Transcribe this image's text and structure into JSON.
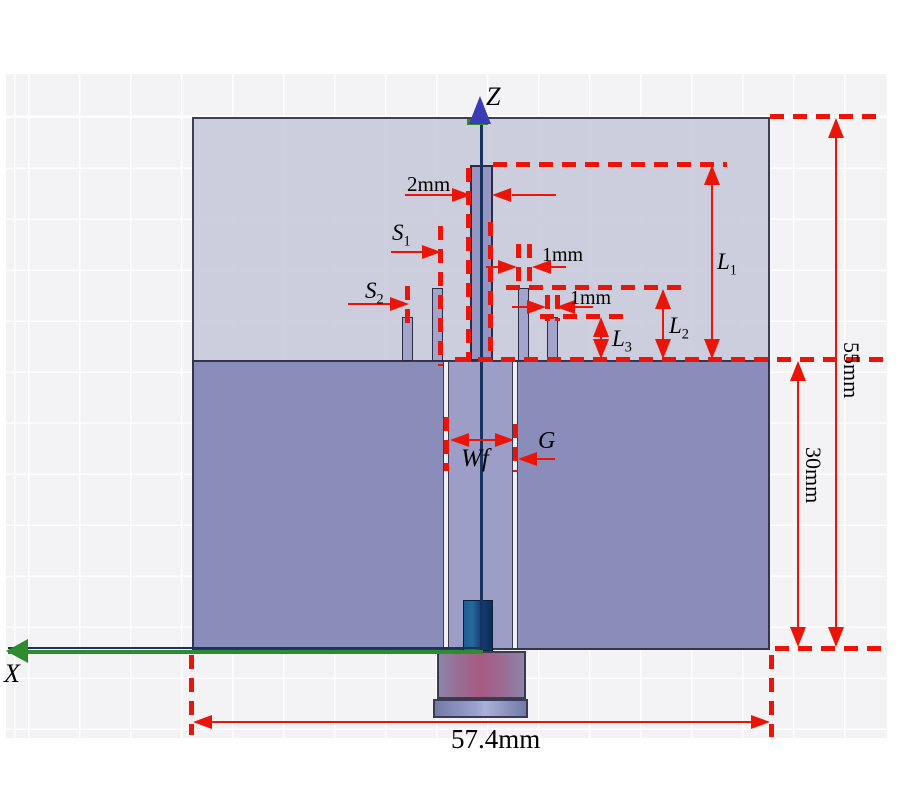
{
  "figure": {
    "axes": {
      "z_label": "Z",
      "x_label": "X"
    },
    "annotations": {
      "monopole_width": "2mm",
      "s1_base": "S",
      "s1_sub": "1",
      "upper_strip_width": "1mm",
      "s2_base": "S",
      "s2_sub": "2",
      "lower_strip_width": "1mm",
      "l1_base": "L",
      "l1_sub": "1",
      "l2_base": "L",
      "l2_sub": "2",
      "l3_base": "L",
      "l3_sub": "3",
      "feedline_width": "Wf",
      "gap_width": "G",
      "substrate_height": "55mm",
      "ground_height": "30mm",
      "board_width": "57.4mm"
    },
    "colors": {
      "grid_area": "#f3f3f5",
      "substrate": "#c8c9d8",
      "ground": "#8a8cba",
      "feed_strip": "#9c9ec8",
      "strip": "#a2a4cc",
      "monopole": "#9597c2",
      "annotation_red": "#ea1408",
      "axis_green": "#2e8b2e",
      "z_arrow_blue": "#3b3bb5",
      "axis_line_navy": "#17335f",
      "pin_blue": "#1b4f86",
      "connector_pink": "#a85a82",
      "flange_blue": "#9ba1cf"
    }
  }
}
